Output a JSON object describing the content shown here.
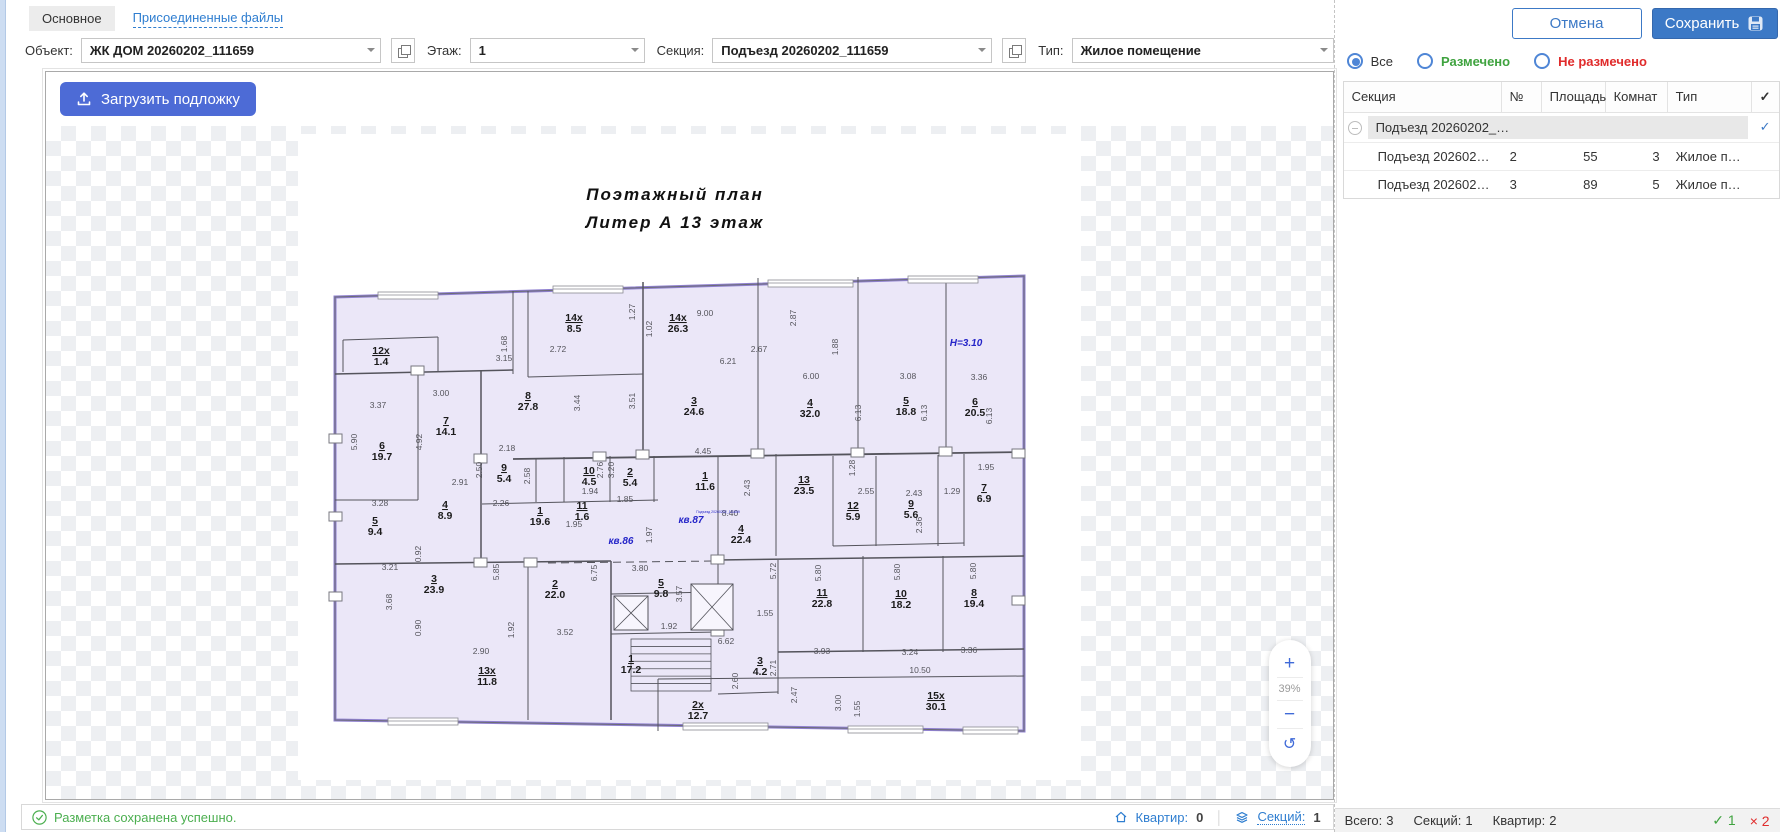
{
  "tabs": {
    "main": "Основное",
    "attached": "Присоединенные файлы"
  },
  "toolbar": {
    "object_label": "Объект:",
    "object_value": "ЖК ДОМ 20260202_111659",
    "floor_label": "Этаж:",
    "floor_value": "1",
    "section_label": "Секция:",
    "section_value": "Подъезд 20260202_111659",
    "type_label": "Тип:",
    "type_value": "Жилое помещение"
  },
  "actions": {
    "cancel": "Отмена",
    "save": "Сохранить"
  },
  "canvas": {
    "upload_button": "Загрузить подложку",
    "zoom_in": "+",
    "zoom_level": "39%",
    "zoom_out": "−",
    "zoom_reset": "↺"
  },
  "statusbar": {
    "message": "Разметка сохранена успешно.",
    "apartments_label": "Квартир:",
    "apartments_value": "0",
    "sections_label": "Секций:",
    "sections_value": "1"
  },
  "filters": {
    "all": "Все",
    "marked": "Размечено",
    "unmarked": "Не размечено"
  },
  "table": {
    "columns": [
      "Секция",
      "№",
      "Площадь",
      "Комнат",
      "Тип"
    ],
    "check_mark": "✓",
    "group_row": {
      "section": "Подъезд 20260202_…",
      "checked": "✓"
    },
    "rows": [
      {
        "section": "Подъезд 202602…",
        "num": "2",
        "area": "55",
        "rooms": "3",
        "type": "Жилое п…"
      },
      {
        "section": "Подъезд 202602…",
        "num": "3",
        "area": "89",
        "rooms": "5",
        "type": "Жилое п…"
      }
    ]
  },
  "footer": {
    "total_label": "Всего:",
    "total_value": "3",
    "sections_label": "Секций:",
    "sections_value": "1",
    "apartments_label": "Квартир:",
    "apartments_value": "2",
    "ok_mark": "✓",
    "ok_count": "1",
    "fail_mark": "×",
    "fail_count": "2"
  },
  "colors": {
    "accent": "#3c79c6",
    "upload_blue": "#4d6bd6",
    "green": "#3fa33f",
    "red": "#e02b2b",
    "plan_fill": "#ebe7f8",
    "plan_stroke": "#8f80d0",
    "checker": "#edeff2",
    "link_blue": "#2f7ed0"
  },
  "plan": {
    "title1": "Поэтажный  план",
    "title2": "Литер А     13 этаж",
    "outline": [
      [
        37,
        163
      ],
      [
        726,
        142
      ],
      [
        726,
        597
      ],
      [
        37,
        586
      ]
    ],
    "walls": [
      [
        45,
        206,
        140,
        203
      ],
      [
        45,
        206,
        45,
        238
      ],
      [
        140,
        203,
        140,
        238
      ],
      [
        37,
        240,
        215,
        236,
        1.5
      ],
      [
        215,
        157,
        215,
        240
      ],
      [
        120,
        238,
        120,
        366
      ],
      [
        183,
        237,
        183,
        430,
        1.5
      ],
      [
        37,
        366,
        120,
        366
      ],
      [
        230,
        157,
        230,
        243
      ],
      [
        230,
        243,
        345,
        240
      ],
      [
        345,
        148,
        345,
        322,
        1.5
      ],
      [
        460,
        144,
        460,
        320
      ],
      [
        560,
        143,
        560,
        320
      ],
      [
        648,
        142,
        648,
        320
      ],
      [
        215,
        325,
        726,
        318,
        1.8
      ],
      [
        238,
        324,
        238,
        368
      ],
      [
        266,
        323,
        266,
        368
      ],
      [
        312,
        322,
        312,
        368
      ],
      [
        356,
        322,
        356,
        368
      ],
      [
        184,
        370,
        360,
        366
      ],
      [
        37,
        430,
        313,
        427,
        1.5
      ],
      [
        230,
        430,
        230,
        586
      ],
      [
        313,
        427,
        313,
        586,
        1.5
      ],
      [
        420,
        322,
        420,
        500
      ],
      [
        478,
        320,
        478,
        422
      ],
      [
        535,
        322,
        535,
        412
      ],
      [
        578,
        322,
        578,
        412
      ],
      [
        640,
        321,
        640,
        412
      ],
      [
        666,
        320,
        666,
        412
      ],
      [
        535,
        412,
        666,
        409
      ],
      [
        420,
        426,
        726,
        422,
        1.5
      ],
      [
        480,
        426,
        480,
        560
      ],
      [
        565,
        422,
        565,
        518
      ],
      [
        645,
        422,
        645,
        518
      ],
      [
        480,
        518,
        726,
        515,
        1.5
      ],
      [
        360,
        545,
        726,
        542
      ],
      [
        360,
        545,
        360,
        597
      ],
      [
        313,
        460,
        420,
        458
      ],
      [
        313,
        500,
        420,
        498
      ],
      [
        420,
        560,
        480,
        558
      ]
    ],
    "dashed": [
      [
        250,
        429,
        418,
        427
      ]
    ],
    "windows": [
      [
        80,
        161,
        60
      ],
      [
        255,
        155,
        70
      ],
      [
        470,
        149,
        85
      ],
      [
        610,
        145,
        70
      ],
      [
        90,
        587,
        70
      ],
      [
        385,
        592,
        85
      ],
      [
        550,
        595,
        75
      ],
      [
        665,
        596,
        55
      ]
    ],
    "columns": [
      [
        31,
        300
      ],
      [
        31,
        378
      ],
      [
        31,
        458
      ],
      [
        113,
        232
      ],
      [
        176,
        320
      ],
      [
        295,
        318
      ],
      [
        338,
        316
      ],
      [
        453,
        315
      ],
      [
        553,
        314
      ],
      [
        641,
        313
      ],
      [
        714,
        315
      ],
      [
        176,
        424
      ],
      [
        226,
        424
      ],
      [
        413,
        421
      ],
      [
        714,
        462
      ],
      [
        413,
        493
      ]
    ],
    "boxes": [
      [
        316,
        462,
        34,
        34
      ],
      [
        393,
        450,
        42,
        46
      ]
    ],
    "stairs": {
      "x": 333,
      "y": 505,
      "w": 80,
      "h": 52,
      "steps": 7
    },
    "rooms": [
      {
        "n": "12x",
        "a": "1.4",
        "x": 83,
        "y": 220
      },
      {
        "n": "6",
        "a": "19.7",
        "x": 84,
        "y": 315
      },
      {
        "n": "7",
        "a": "14.1",
        "x": 148,
        "y": 290
      },
      {
        "n": "8",
        "a": "27.8",
        "x": 230,
        "y": 265
      },
      {
        "n": "14x",
        "a": "8.5",
        "x": 276,
        "y": 187
      },
      {
        "n": "14x",
        "a": "26.3",
        "x": 380,
        "y": 187
      },
      {
        "n": "9",
        "a": "5.4",
        "x": 206,
        "y": 337
      },
      {
        "n": "10",
        "a": "4.5",
        "x": 291,
        "y": 340
      },
      {
        "n": "2",
        "a": "5.4",
        "x": 332,
        "y": 341
      },
      {
        "n": "4",
        "a": "8.9",
        "x": 147,
        "y": 374
      },
      {
        "n": "11",
        "a": "1.6",
        "x": 284,
        "y": 375
      },
      {
        "n": "1",
        "a": "19.6",
        "x": 242,
        "y": 380
      },
      {
        "n": "5",
        "a": "9.4",
        "x": 77,
        "y": 390
      },
      {
        "n": "3",
        "a": "23.9",
        "x": 136,
        "y": 448
      },
      {
        "n": "2",
        "a": "22.0",
        "x": 257,
        "y": 453
      },
      {
        "n": "13x",
        "a": "11.8",
        "x": 189,
        "y": 540
      },
      {
        "n": "1",
        "a": "17.2",
        "x": 333,
        "y": 528
      },
      {
        "n": "5",
        "a": "9.8",
        "x": 363,
        "y": 452
      },
      {
        "n": "3",
        "a": "24.6",
        "x": 396,
        "y": 270
      },
      {
        "n": "4",
        "a": "32.0",
        "x": 512,
        "y": 272
      },
      {
        "n": "5",
        "a": "18.8",
        "x": 608,
        "y": 270
      },
      {
        "n": "6",
        "a": "20.5",
        "x": 677,
        "y": 271
      },
      {
        "n": "1",
        "a": "11.6",
        "x": 407,
        "y": 345
      },
      {
        "n": "13",
        "a": "23.5",
        "x": 506,
        "y": 349
      },
      {
        "n": "12",
        "a": "5.9",
        "x": 555,
        "y": 375
      },
      {
        "n": "9",
        "a": "5.6",
        "x": 613,
        "y": 373
      },
      {
        "n": "7",
        "a": "6.9",
        "x": 686,
        "y": 357
      },
      {
        "n": "4",
        "a": "22.4",
        "x": 443,
        "y": 398
      },
      {
        "n": "11",
        "a": "22.8",
        "x": 524,
        "y": 462
      },
      {
        "n": "10",
        "a": "18.2",
        "x": 603,
        "y": 463
      },
      {
        "n": "8",
        "a": "19.4",
        "x": 676,
        "y": 462
      },
      {
        "n": "3",
        "a": "4.2",
        "x": 462,
        "y": 530
      },
      {
        "n": "2x",
        "a": "12.7",
        "x": 400,
        "y": 574
      },
      {
        "n": "15x",
        "a": "30.1",
        "x": 638,
        "y": 565
      }
    ],
    "dims": [
      {
        "t": "3.37",
        "x": 80,
        "y": 274
      },
      {
        "t": "3.00",
        "x": 143,
        "y": 262
      },
      {
        "t": "3.15",
        "x": 206,
        "y": 227
      },
      {
        "t": "1.68",
        "x": 209,
        "y": 210,
        "r": 1
      },
      {
        "t": "2.72",
        "x": 260,
        "y": 218
      },
      {
        "t": "5.90",
        "x": 59,
        "y": 308,
        "r": 1
      },
      {
        "t": "4.92",
        "x": 124,
        "y": 308,
        "r": 1
      },
      {
        "t": "2.91",
        "x": 162,
        "y": 351
      },
      {
        "t": "3.28",
        "x": 82,
        "y": 372
      },
      {
        "t": "2.18",
        "x": 209,
        "y": 317
      },
      {
        "t": "2.50",
        "x": 184,
        "y": 336,
        "r": 1
      },
      {
        "t": "2.58",
        "x": 232,
        "y": 342,
        "r": 1
      },
      {
        "t": "2.26",
        "x": 203,
        "y": 372
      },
      {
        "t": "3.44",
        "x": 282,
        "y": 269,
        "r": 1
      },
      {
        "t": "3.51",
        "x": 337,
        "y": 267,
        "r": 1
      },
      {
        "t": "1.94",
        "x": 292,
        "y": 360
      },
      {
        "t": "1.85",
        "x": 327,
        "y": 368
      },
      {
        "t": "3.20",
        "x": 316,
        "y": 336,
        "r": 1
      },
      {
        "t": "2.76",
        "x": 305,
        "y": 336,
        "r": 1
      },
      {
        "t": "9.00",
        "x": 407,
        "y": 182
      },
      {
        "t": "2.87",
        "x": 498,
        "y": 184,
        "r": 1
      },
      {
        "t": "2.67",
        "x": 461,
        "y": 218
      },
      {
        "t": "1.88",
        "x": 540,
        "y": 213,
        "r": 1
      },
      {
        "t": "6.00",
        "x": 513,
        "y": 245
      },
      {
        "t": "3.08",
        "x": 610,
        "y": 245
      },
      {
        "t": "3.36",
        "x": 681,
        "y": 246
      },
      {
        "t": "6.13",
        "x": 563,
        "y": 279,
        "r": 1
      },
      {
        "t": "6.13",
        "x": 629,
        "y": 279,
        "r": 1
      },
      {
        "t": "6.13",
        "x": 694,
        "y": 282,
        "r": 1
      },
      {
        "t": "4.45",
        "x": 405,
        "y": 320
      },
      {
        "t": "2.43",
        "x": 452,
        "y": 354,
        "r": 1
      },
      {
        "t": "1.28",
        "x": 557,
        "y": 334,
        "r": 1
      },
      {
        "t": "2.55",
        "x": 568,
        "y": 360
      },
      {
        "t": "2.43",
        "x": 616,
        "y": 362
      },
      {
        "t": "1.29",
        "x": 654,
        "y": 360
      },
      {
        "t": "1.95",
        "x": 688,
        "y": 336
      },
      {
        "t": "8.40",
        "x": 432,
        "y": 382
      },
      {
        "t": "3.21",
        "x": 92,
        "y": 436
      },
      {
        "t": "3.68",
        "x": 94,
        "y": 468,
        "r": 1
      },
      {
        "t": "0.92",
        "x": 123,
        "y": 420,
        "r": 1
      },
      {
        "t": "5.85",
        "x": 201,
        "y": 438,
        "r": 1
      },
      {
        "t": "6.75",
        "x": 299,
        "y": 439,
        "r": 1
      },
      {
        "t": "3.80",
        "x": 342,
        "y": 437
      },
      {
        "t": "0.90",
        "x": 123,
        "y": 494,
        "r": 1
      },
      {
        "t": "2.90",
        "x": 183,
        "y": 520
      },
      {
        "t": "1.92",
        "x": 216,
        "y": 496,
        "r": 1
      },
      {
        "t": "3.52",
        "x": 267,
        "y": 501
      },
      {
        "t": "1.95",
        "x": 276,
        "y": 393
      },
      {
        "t": "1.97",
        "x": 354,
        "y": 401,
        "r": 1
      },
      {
        "t": "1.92",
        "x": 371,
        "y": 495
      },
      {
        "t": "5.72",
        "x": 478,
        "y": 437,
        "r": 1
      },
      {
        "t": "5.80",
        "x": 523,
        "y": 439,
        "r": 1
      },
      {
        "t": "5.80",
        "x": 602,
        "y": 438,
        "r": 1
      },
      {
        "t": "5.80",
        "x": 678,
        "y": 437,
        "r": 1
      },
      {
        "t": "3.93",
        "x": 524,
        "y": 520
      },
      {
        "t": "3.24",
        "x": 612,
        "y": 521
      },
      {
        "t": "3.36",
        "x": 671,
        "y": 519
      },
      {
        "t": "10.50",
        "x": 622,
        "y": 539
      },
      {
        "t": "1.55",
        "x": 467,
        "y": 482
      },
      {
        "t": "6.62",
        "x": 428,
        "y": 510
      },
      {
        "t": "2.60",
        "x": 440,
        "y": 547,
        "r": 1
      },
      {
        "t": "2.71",
        "x": 478,
        "y": 534,
        "r": 1
      },
      {
        "t": "2.47",
        "x": 499,
        "y": 561,
        "r": 1
      },
      {
        "t": "3.00",
        "x": 543,
        "y": 569,
        "r": 1
      },
      {
        "t": "3.57",
        "x": 384,
        "y": 460,
        "r": 1
      },
      {
        "t": "2.36",
        "x": 624,
        "y": 391,
        "r": 1
      },
      {
        "t": "1.55",
        "x": 562,
        "y": 575,
        "r": 1
      },
      {
        "t": "6.21",
        "x": 430,
        "y": 230
      },
      {
        "t": "1.27",
        "x": 337,
        "y": 178,
        "r": 1
      },
      {
        "t": "1.02",
        "x": 354,
        "y": 195,
        "r": 1
      }
    ],
    "blue_labels": [
      {
        "t": "кв.86",
        "x": 323,
        "y": 410
      },
      {
        "t": "кв.87",
        "x": 393,
        "y": 389
      },
      {
        "t": "H=3.10",
        "x": 668,
        "y": 212
      },
      {
        "t": "Подъезд 20260202_111659",
        "x": 420,
        "y": 379,
        "small": 1
      }
    ]
  }
}
